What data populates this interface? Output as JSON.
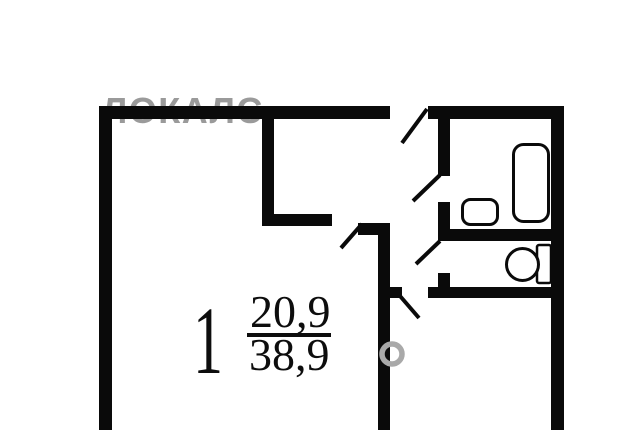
{
  "plan": {
    "room": {
      "number": "1",
      "living_area": "20,9",
      "total_area": "38,9"
    },
    "watermark": {
      "text": "ЛОКАЛС",
      "color": "#9a9a9a",
      "ring_color": "#a9a9a9"
    },
    "colors": {
      "wall": "#0a0a0a",
      "background": "#ffffff",
      "text": "#0d0d0d"
    },
    "fixtures": [
      {
        "name": "bathtub"
      },
      {
        "name": "sink"
      },
      {
        "name": "toilet"
      }
    ],
    "doors": [
      {
        "name": "entrance-door"
      },
      {
        "name": "bathroom-door"
      },
      {
        "name": "toilet-door"
      },
      {
        "name": "hall-door"
      },
      {
        "name": "room-door"
      }
    ]
  }
}
